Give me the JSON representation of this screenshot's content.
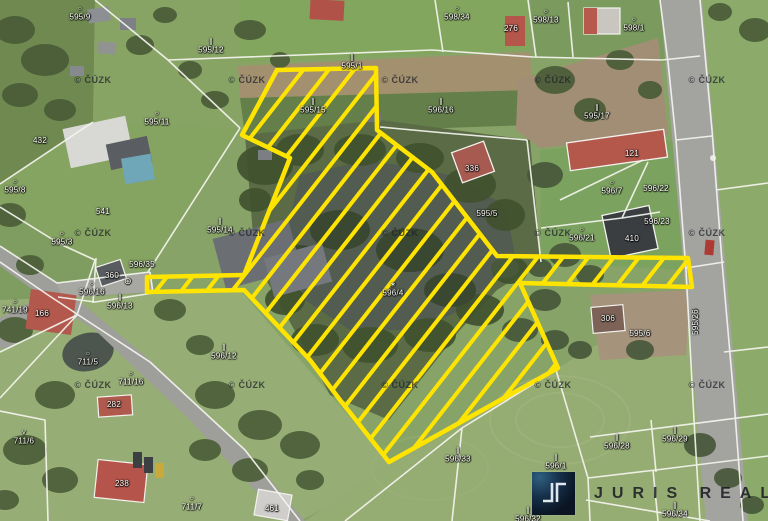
{
  "map": {
    "type": "cadastral-aerial-map",
    "copyright_text": "© ČÚZK",
    "watermarks": {
      "xs": [
        93,
        247,
        400,
        553,
        707
      ],
      "ys": [
        80,
        233,
        385
      ]
    },
    "highlight_color": "#ffe400",
    "symbol_glyphs": {
      "o": "○",
      "m": "∥",
      "v": "⋎",
      "w": "∗"
    },
    "labels": [
      {
        "text": "595/9",
        "x": 80,
        "y": 14,
        "sym": "o"
      },
      {
        "text": "595/12",
        "x": 211,
        "y": 47,
        "sym": "m"
      },
      {
        "text": "595/11",
        "x": 157,
        "y": 119,
        "sym": "o"
      },
      {
        "text": "595/1",
        "x": 352,
        "y": 63,
        "sym": "m"
      },
      {
        "text": "598/34",
        "x": 457,
        "y": 14,
        "sym": "o"
      },
      {
        "text": "598/13",
        "x": 546,
        "y": 17,
        "sym": "o"
      },
      {
        "text": "598/1",
        "x": 634,
        "y": 25,
        "sym": "o"
      },
      {
        "text": "595/15",
        "x": 313,
        "y": 107,
        "sym": "m"
      },
      {
        "text": "596/16",
        "x": 441,
        "y": 107,
        "sym": "m"
      },
      {
        "text": "595/17",
        "x": 597,
        "y": 113,
        "sym": "m"
      },
      {
        "text": "595/8",
        "x": 15,
        "y": 187,
        "sym": "o"
      },
      {
        "text": "595/3",
        "x": 62,
        "y": 239,
        "sym": "o"
      },
      {
        "text": "595/14",
        "x": 220,
        "y": 227,
        "sym": "m"
      },
      {
        "text": "595/5",
        "x": 487,
        "y": 214
      },
      {
        "text": "596/7",
        "x": 612,
        "y": 188,
        "sym": "o"
      },
      {
        "text": "596/22",
        "x": 656,
        "y": 189
      },
      {
        "text": "596/21",
        "x": 582,
        "y": 235,
        "sym": "o"
      },
      {
        "text": "596/23",
        "x": 657,
        "y": 222
      },
      {
        "text": "596/35",
        "x": 142,
        "y": 265
      },
      {
        "text": "596/16",
        "x": 92,
        "y": 289,
        "sym": "o"
      },
      {
        "text": "⊕",
        "x": 128,
        "y": 281,
        "kind": "symbol"
      },
      {
        "text": "596/13",
        "x": 120,
        "y": 303,
        "sym": "m"
      },
      {
        "text": "741/19",
        "x": 15,
        "y": 307,
        "sym": "o"
      },
      {
        "text": "711/5",
        "x": 88,
        "y": 359,
        "sym": "o"
      },
      {
        "text": "711/16",
        "x": 131,
        "y": 379,
        "sym": "o"
      },
      {
        "text": "596/12",
        "x": 224,
        "y": 353,
        "sym": "m"
      },
      {
        "text": "711/6",
        "x": 24,
        "y": 438,
        "sym": "v"
      },
      {
        "text": "711/7",
        "x": 192,
        "y": 504,
        "sym": "o"
      },
      {
        "text": "596/4",
        "x": 393,
        "y": 290,
        "sym": "w"
      },
      {
        "text": "595/6",
        "x": 640,
        "y": 334
      },
      {
        "text": "595/26",
        "x": 696,
        "y": 322,
        "vert": true
      },
      {
        "text": "596/33",
        "x": 458,
        "y": 456,
        "sym": "m"
      },
      {
        "text": "596/1",
        "x": 556,
        "y": 463,
        "sym": "m"
      },
      {
        "text": "596/28",
        "x": 617,
        "y": 443,
        "sym": "m"
      },
      {
        "text": "596/29",
        "x": 675,
        "y": 436,
        "sym": "m"
      },
      {
        "text": "596/34",
        "x": 675,
        "y": 511,
        "sym": "m"
      },
      {
        "text": "596/32",
        "x": 528,
        "y": 516,
        "sym": "m"
      },
      {
        "text": "276",
        "x": 511,
        "y": 29,
        "kind": "building"
      },
      {
        "text": "432",
        "x": 40,
        "y": 141,
        "kind": "building"
      },
      {
        "text": "541",
        "x": 103,
        "y": 212,
        "kind": "building"
      },
      {
        "text": "336",
        "x": 472,
        "y": 169,
        "kind": "building"
      },
      {
        "text": "121",
        "x": 632,
        "y": 154,
        "kind": "building"
      },
      {
        "text": "410",
        "x": 632,
        "y": 239,
        "kind": "building"
      },
      {
        "text": "166",
        "x": 42,
        "y": 314,
        "kind": "building"
      },
      {
        "text": "360",
        "x": 112,
        "y": 276,
        "kind": "building"
      },
      {
        "text": "282",
        "x": 114,
        "y": 405,
        "kind": "building"
      },
      {
        "text": "238",
        "x": 122,
        "y": 484,
        "kind": "building"
      },
      {
        "text": "306",
        "x": 608,
        "y": 319,
        "kind": "building"
      },
      {
        "text": "461",
        "x": 272,
        "y": 509,
        "kind": "building"
      }
    ]
  },
  "logo": {
    "brand": "JURIS REAL",
    "word": "JURIS REAL"
  }
}
